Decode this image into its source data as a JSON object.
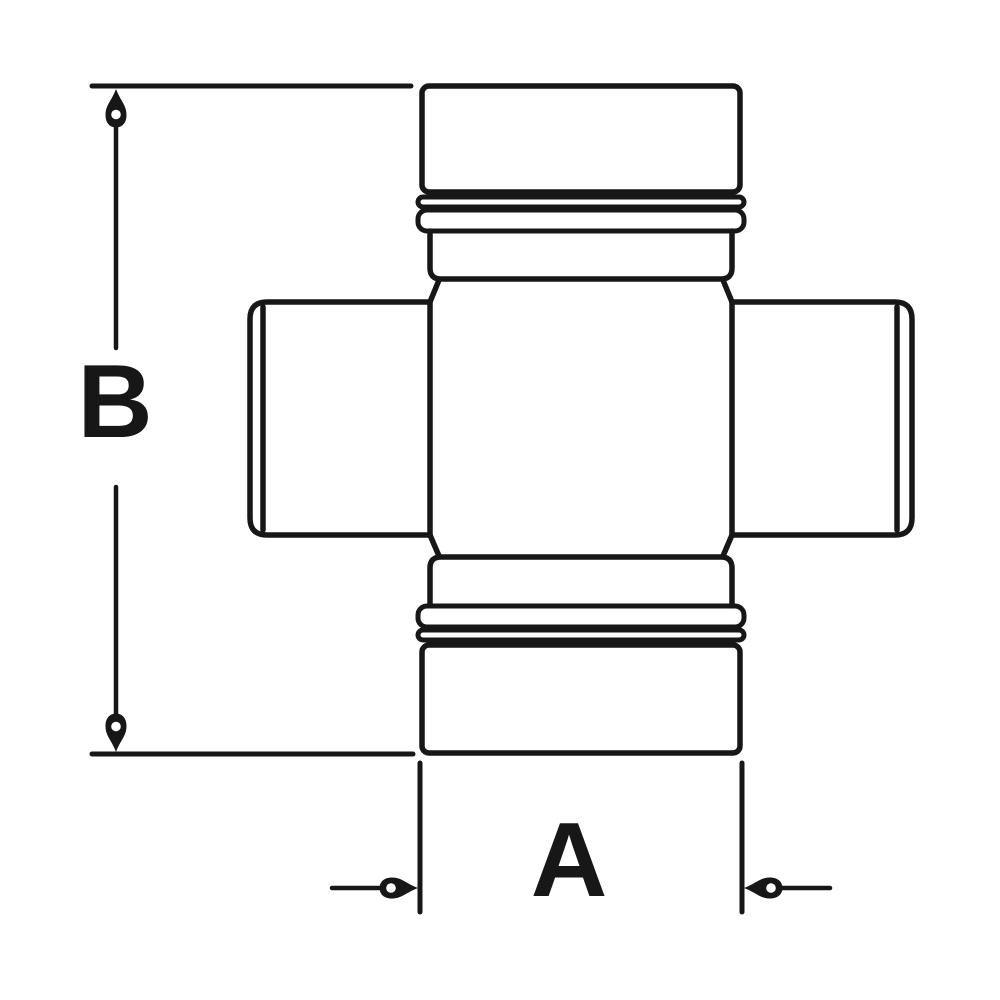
{
  "drawing": {
    "type": "technical-dimension-drawing",
    "subject": "universal-joint-cross-with-bearing-caps",
    "colors": {
      "line": "#171717",
      "background": "#ffffff"
    },
    "dimensions": {
      "vertical": {
        "label": "B"
      },
      "horizontal": {
        "label": "A"
      }
    }
  }
}
